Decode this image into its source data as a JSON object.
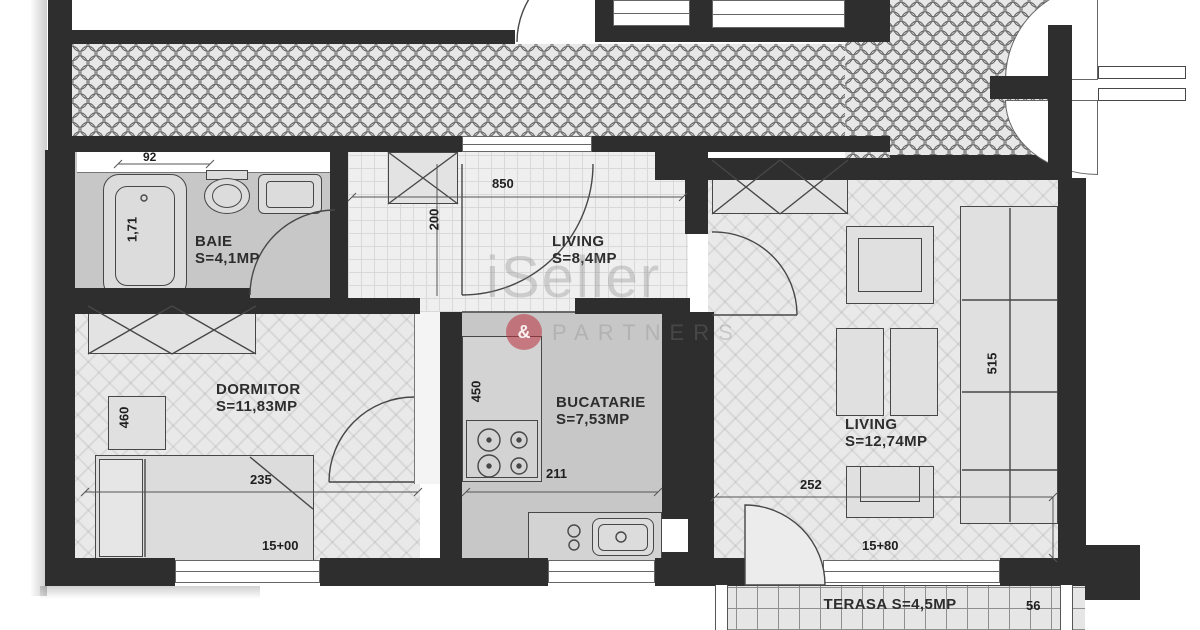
{
  "watermark": {
    "brand": "iSeller",
    "ampersand": "&",
    "subtitle": "PARTNERS"
  },
  "rooms": {
    "baie": {
      "name": "BAIE",
      "area": "S=4,1MP"
    },
    "hol": {
      "name": "LIVING",
      "area": "S=8,4MP"
    },
    "dormitor": {
      "name": "DORMITOR",
      "area": "S=11,83MP"
    },
    "bucatarie": {
      "name": "BUCATARIE",
      "area": "S=7,53MP"
    },
    "living": {
      "name": "LIVING",
      "area": "S=12,74MP"
    },
    "terasa": {
      "label": "TERASA S=4,5MP"
    }
  },
  "dimensions": {
    "bath_niche": "92",
    "bathtub": "1,71",
    "hall_width": "850",
    "hall_depth": "200",
    "bedroom_depth": "460",
    "bedroom_width": "235",
    "kitchen_counter": "450",
    "kitchen_width": "211",
    "living_width": "252",
    "sofa": "515",
    "bedroom_window": "15+00",
    "living_window": "15+80",
    "terrace_edge": "56"
  },
  "colors": {
    "wall": "#2e2e2e",
    "gray_room": "#c7c7c7",
    "watermark_red": "#b92d3c"
  }
}
